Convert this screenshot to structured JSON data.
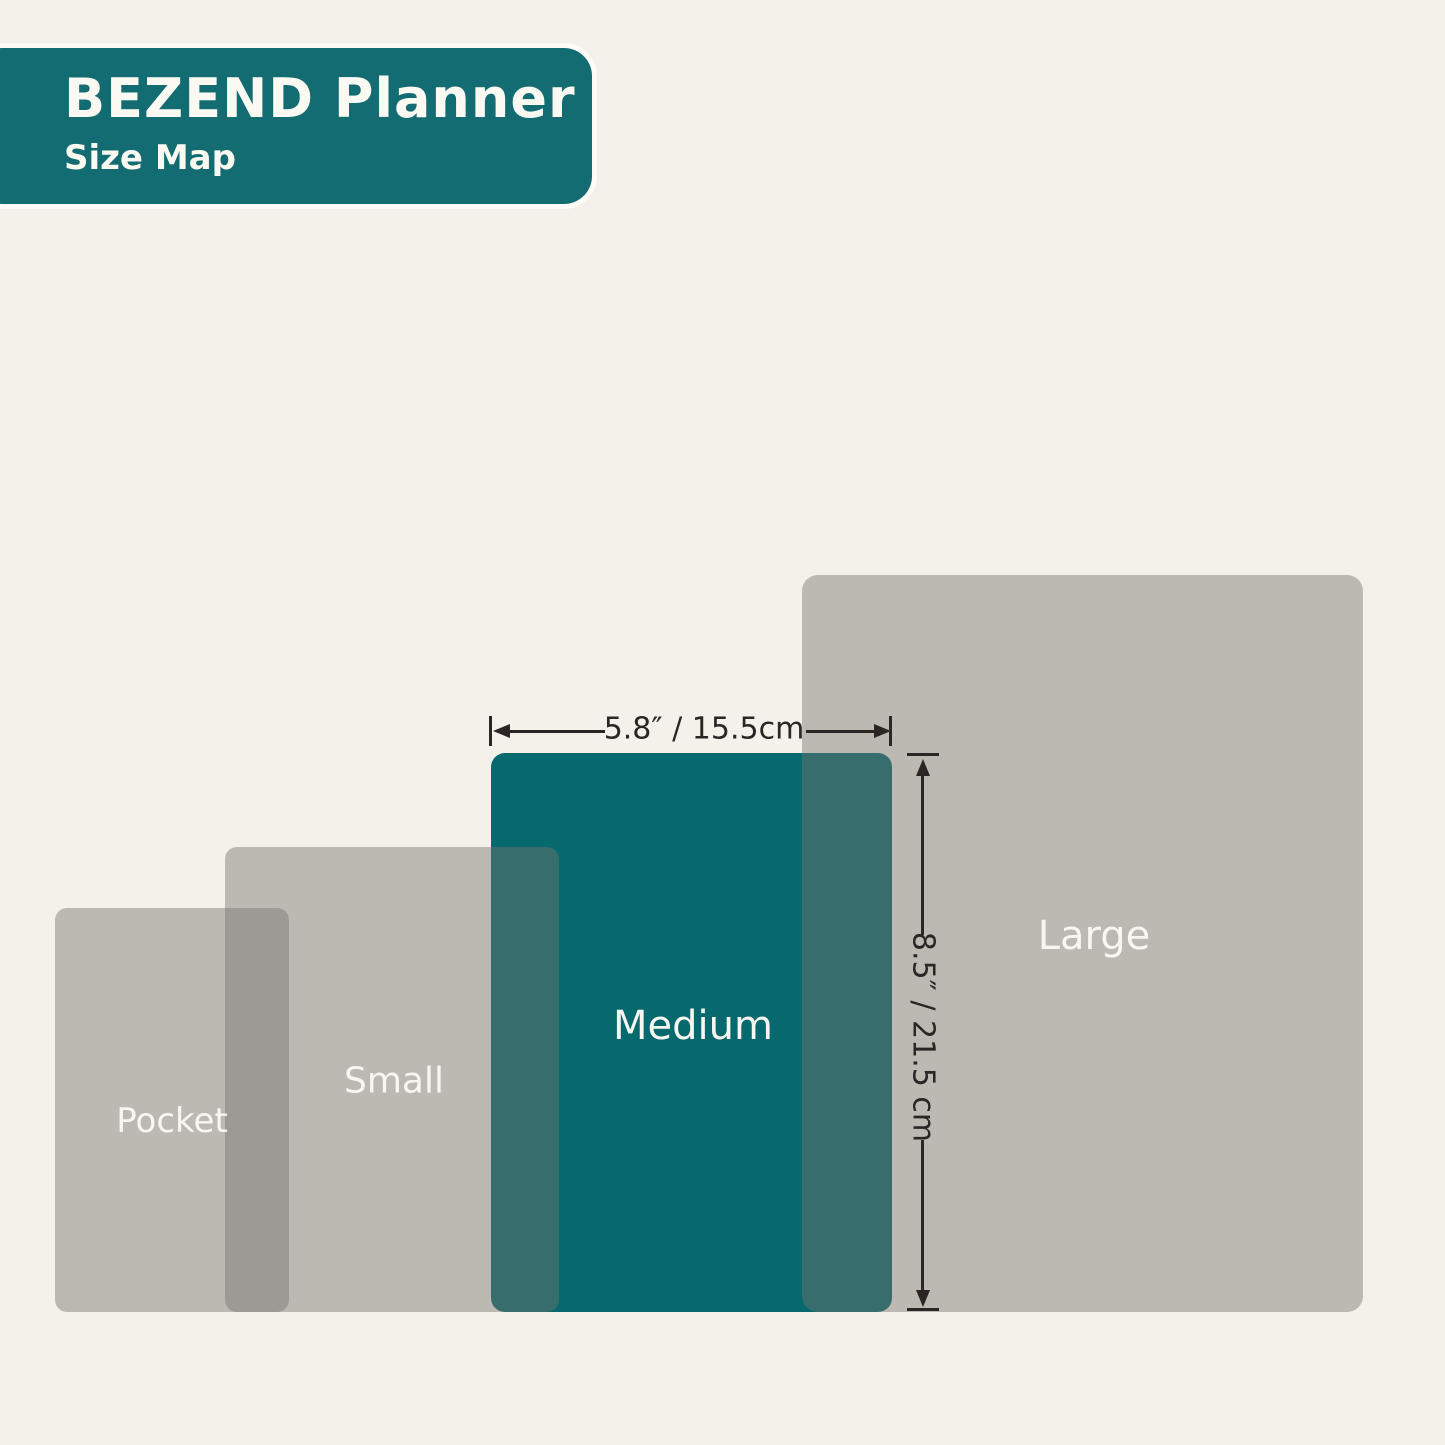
{
  "header": {
    "title": "BEZEND Planner",
    "subtitle": "Size Map"
  },
  "sizes": [
    {
      "id": "pocket",
      "label": "Pocket",
      "highlighted": false
    },
    {
      "id": "small",
      "label": "Small",
      "highlighted": false
    },
    {
      "id": "medium",
      "label": "Medium",
      "highlighted": true,
      "width_label": "5.8″ / 15.5cm",
      "height_label": "8.5″ / 21.5 cm"
    },
    {
      "id": "large",
      "label": "Large",
      "highlighted": false
    }
  ],
  "dimensions": {
    "width_label": "5.8″ / 15.5cm",
    "height_label": "8.5″ / 21.5 cm"
  },
  "colors": {
    "background": "#f4f1ea",
    "badge_teal": "#136c72",
    "highlight_teal": "#05696e",
    "size_gray": "#b9b5b0",
    "label_text": "#f7f6f0",
    "dimension_ink": "#2b2526"
  }
}
